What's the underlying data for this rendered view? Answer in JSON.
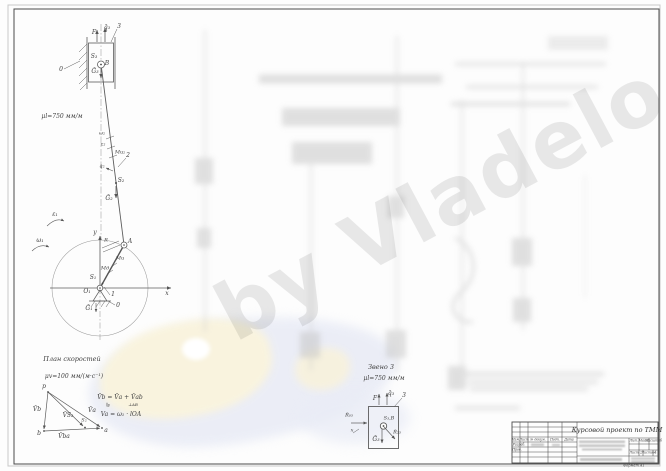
{
  "watermark": {
    "text": "by Vladelo"
  },
  "mechanism": {
    "scale_note": "μl=750 мм/м",
    "labels": {
      "f": "F",
      "q3": "q̄₃",
      "link3": "3",
      "s3": "S₃",
      "b": "B",
      "g3": "Ḡ₃",
      "ground": "0",
      "omega2": "ω₂",
      "eps2": "ε₂",
      "mi2": "Ми₂",
      "link2": "2",
      "q2": "q̄₂",
      "s2": "S₂",
      "g2": "Ḡ₂",
      "eps1": "ε₁",
      "omega1": "ω₁",
      "axis_y": "y",
      "axis_x": "x",
      "a": "A",
      "r": "R",
      "mi": "Ми",
      "md": "Мд",
      "s1": "S₁",
      "o1": "O₁",
      "g1": "Ḡ₁",
      "link1": "1",
      "ground1": "0"
    }
  },
  "velocity_plan": {
    "title": "План скоростей",
    "scale_note": "μv=100 мм/(м·с⁻¹)",
    "points": {
      "p": "p",
      "b": "b",
      "a": "a",
      "s2": "S₂"
    },
    "vectors": {
      "vb": "V̄b",
      "vs2": "V̄S₂",
      "va": "V̄a",
      "vba": "V̄ba"
    },
    "eq1": "V̄b = V̄a + V̄ab",
    "eq1_sub_left": "∥y",
    "eq1_sub_right": "⊥AB",
    "eq2": "Va = ω₁ · lOA"
  },
  "link3_diagram": {
    "title": "Звено 3",
    "scale_note": "μl=750 мм/м",
    "labels": {
      "f": "F",
      "q3": "q̄₃",
      "link": "3",
      "s3b": "S₃,B",
      "r23": "R̄₂₃",
      "g3": "Ḡ₃",
      "r03": "R̄₀₃",
      "x": "x"
    }
  },
  "title_block": {
    "title": "Курсовой проект по ТММ",
    "col_izm": "Изм.",
    "col_list": "Лист",
    "col_doc": "№ докум.",
    "col_podp": "Подп.",
    "col_data": "Дата",
    "row_razrab": "Разраб.",
    "row_prov": "Пров.",
    "lit": "Лит.",
    "mass": "Масса",
    "scale": "Масштаб",
    "sheet_label": "Лист",
    "sheet_value": "2",
    "sheets_label": "Листов",
    "sheets_value": "4",
    "format": "Формат А1"
  }
}
